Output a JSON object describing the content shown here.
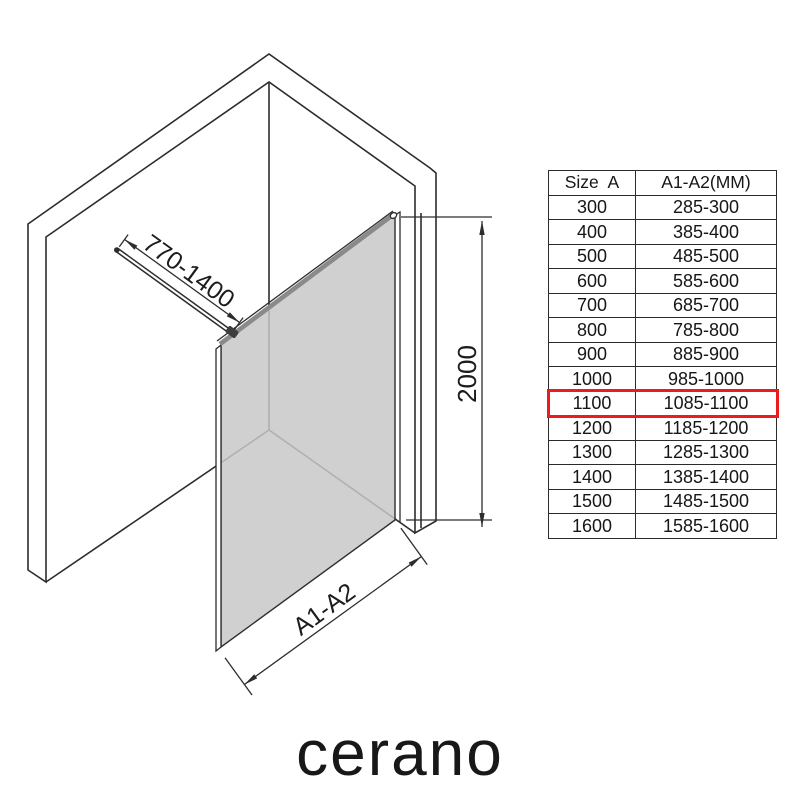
{
  "diagram": {
    "labels": {
      "bar_range": "770-1400",
      "height": "2000",
      "width": "A1-A2"
    },
    "glass_color": "#c8c8c8",
    "line_color": "#2d2d2d"
  },
  "table": {
    "headers": [
      "Size  A",
      "A1-A2(MM)"
    ],
    "rows": [
      [
        "300",
        "285-300"
      ],
      [
        "400",
        "385-400"
      ],
      [
        "500",
        "485-500"
      ],
      [
        "600",
        "585-600"
      ],
      [
        "700",
        "685-700"
      ],
      [
        "800",
        "785-800"
      ],
      [
        "900",
        "885-900"
      ],
      [
        "1000",
        "985-1000"
      ],
      [
        "1100",
        "1085-1100"
      ],
      [
        "1200",
        "1185-1200"
      ],
      [
        "1300",
        "1285-1300"
      ],
      [
        "1400",
        "1385-1400"
      ],
      [
        "1500",
        "1485-1500"
      ],
      [
        "1600",
        "1585-1600"
      ]
    ],
    "highlighted_size": "1100",
    "highlight_color": "#ec1c1c"
  },
  "logo": {
    "text": "cerano"
  }
}
